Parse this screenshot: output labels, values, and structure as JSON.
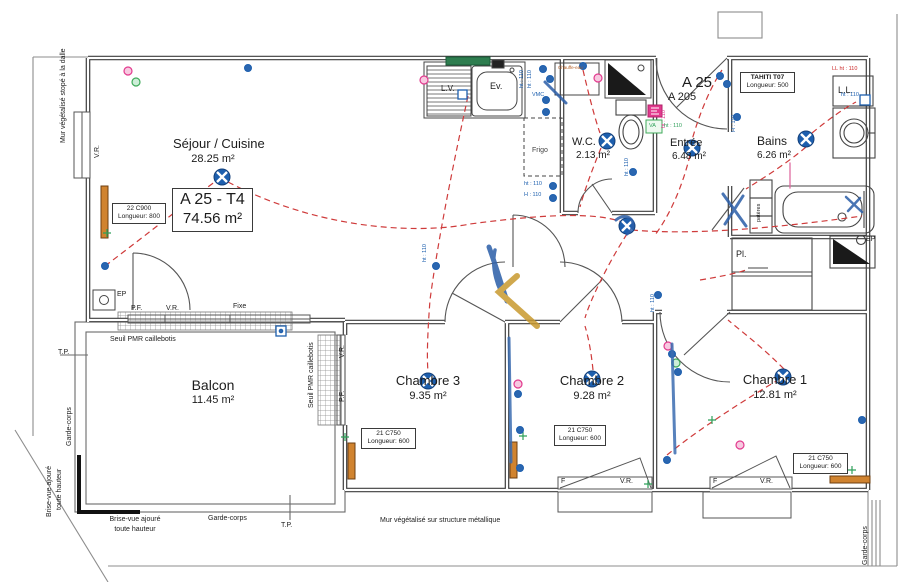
{
  "unit": {
    "code": "A 25 - T4",
    "area": "74.56 m²",
    "apartment": "A 25",
    "door_ref": "A 205"
  },
  "rooms": {
    "sejour": {
      "name": "Séjour / Cuisine",
      "area": "28.25 m²"
    },
    "wc": {
      "name": "W.C.",
      "area": "2.13 m²"
    },
    "entree": {
      "name": "Entrée",
      "area": "6.48 m²"
    },
    "bains": {
      "name": "Bains",
      "area": "6.26 m²"
    },
    "chambre1": {
      "name": "Chambre 1",
      "area": "12.81 m²"
    },
    "chambre2": {
      "name": "Chambre 2",
      "area": "9.28 m²"
    },
    "chambre3": {
      "name": "Chambre 3",
      "area": "9.35 m²"
    },
    "balcon": {
      "name": "Balcon",
      "area": "11.45 m²"
    }
  },
  "radiators": {
    "sejour": {
      "model": "22 C900",
      "length": "Longueur: 800"
    },
    "bains": {
      "model": "TAHITI T07",
      "length": "Longueur: 500"
    },
    "chambre3": {
      "model": "21 C750",
      "length": "Longueur: 600"
    },
    "chambre2": {
      "model": "21 C750",
      "length": "Longueur: 600"
    },
    "chambre1": {
      "model": "21 C750",
      "length": "Longueur: 600"
    }
  },
  "fixtures": {
    "lave_vaisselle": "L.V.",
    "evier": "Ev.",
    "frigo": "Frigo",
    "chauffe_eau": "Chauffe-eau",
    "lave_linge": "L.L.",
    "placard": "Pl.",
    "ep": "EP",
    "pateres": "patères",
    "va": "VA"
  },
  "window_labels": {
    "pf": "P.F.",
    "vr": "V.R.",
    "fixe": "Fixe",
    "f": "F"
  },
  "heights": {
    "ht": "ht : 110",
    "h": "H : 110",
    "ll": "LL ht : 110",
    "vmc": "VMC"
  },
  "site": {
    "mur_left": "Mur végétalisé stopé à la dalle",
    "mur_bottom": "Mur végétalisé sur structure métallique",
    "seuil_pmr": "Seuil PMR caillebotis",
    "garde_corps": "Garde-corps",
    "brise_vue_1": "Brise-vue ajouré",
    "brise_vue_2": "toute hauteur",
    "tp": "T.P."
  },
  "colors": {
    "electric_blue": "#1d5fae",
    "cable_red": "#cf3b3b",
    "socket_pink": "#e23a8e",
    "socket_green": "#3faa5a",
    "radiator_orange": "#d0832f",
    "pen_gold": "#c8992e"
  }
}
